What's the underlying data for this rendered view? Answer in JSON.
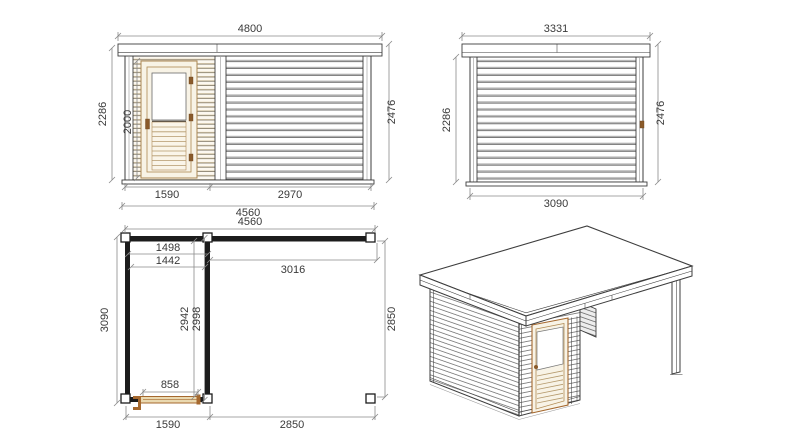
{
  "drawing": {
    "type": "garden-cabin-technical-drawing",
    "views": [
      "front-elevation",
      "side-elevation",
      "floor-plan",
      "isometric-view"
    ]
  },
  "front_elevation": {
    "dims": {
      "overall_width": "4800",
      "wall_height_left": "2286",
      "door_height": "2000",
      "wall_height_right": "2476",
      "door_section_width": "1590",
      "main_section_width": "2970",
      "base_width": "4560"
    }
  },
  "side_elevation": {
    "dims": {
      "roof_width": "3331",
      "wall_height_left": "2286",
      "wall_height_right": "2476",
      "base_width": "3090"
    }
  },
  "floor_plan": {
    "dims": {
      "overall_width": "4560",
      "room_inner_width_a": "1498",
      "room_inner_width_b": "1442",
      "canopy_inner_width": "3016",
      "side_depth": "3090",
      "room_inner_depth_a": "2942",
      "room_inner_depth_b": "2998",
      "canopy_depth": "2850",
      "door_opening_width": "858",
      "room_outer_width": "1590",
      "canopy_outer_width": "2850"
    }
  },
  "colors": {
    "line": "#3d3d3d",
    "dimension": "#8a8a8a",
    "wall_black": "#1c1c1c",
    "door_cream": "#f8f3e6",
    "wood_tan": "#ad8752",
    "accent_brown": "#8a5a2a",
    "plan_door_fill": "#ead9b0",
    "roof_highlight_yellow": "#ebe4a9",
    "board_shadow": "#b0b0b0"
  }
}
